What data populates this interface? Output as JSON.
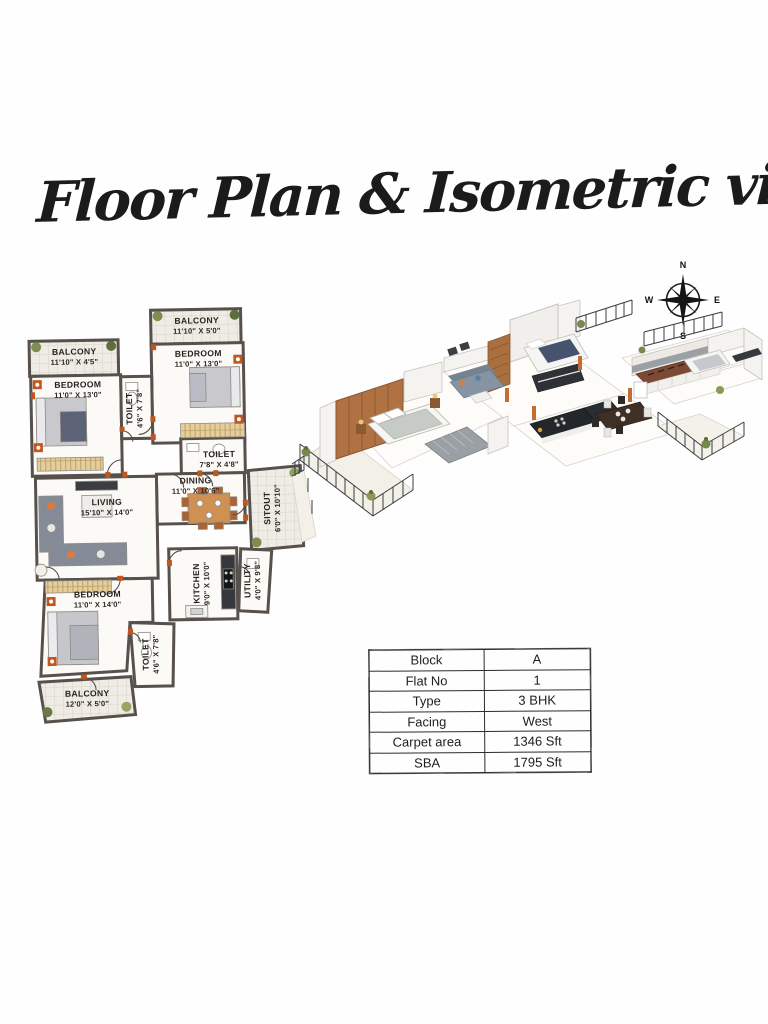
{
  "page": {
    "title": "Floor Plan & Isometric view"
  },
  "compass": {
    "north": "N",
    "east": "E",
    "south": "S",
    "west": "W"
  },
  "floor_plan": {
    "rooms": [
      {
        "id": "balcony-top",
        "name": "BALCONY",
        "dims": "11'10\" X 5'0\""
      },
      {
        "id": "bedroom-2",
        "name": "BEDROOM",
        "dims": "11'0\" X 13'0\""
      },
      {
        "id": "balcony-left",
        "name": "BALCONY",
        "dims": "11'10\" X 4'5\""
      },
      {
        "id": "bedroom-1",
        "name": "BEDROOM",
        "dims": "11'0\" X 13'0\""
      },
      {
        "id": "toilet-1",
        "name": "TOILET",
        "dims": "4'6\" X 7'8\""
      },
      {
        "id": "toilet-2",
        "name": "TOILET",
        "dims": "7'8\" X 4'8\""
      },
      {
        "id": "dining",
        "name": "DINING",
        "dims": "11'0\" X 10'6\""
      },
      {
        "id": "sitout",
        "name": "SITOUT",
        "dims": "6'0\" X 10'10\""
      },
      {
        "id": "living",
        "name": "LIVING",
        "dims": "15'10\" X 14'0\""
      },
      {
        "id": "kitchen",
        "name": "KITCHEN",
        "dims": "9'0\" X 10'0\""
      },
      {
        "id": "utility",
        "name": "UTILITY",
        "dims": "4'0\" X 9'8\""
      },
      {
        "id": "bedroom-3",
        "name": "BEDROOM",
        "dims": "11'0\" X 14'0\""
      },
      {
        "id": "toilet-3",
        "name": "TOILET",
        "dims": "4'6\" X 7'8\""
      },
      {
        "id": "balcony-bottom",
        "name": "BALCONY",
        "dims": "12'0\" X 5'0\""
      }
    ],
    "colors": {
      "wall": "#57504b",
      "door_accent": "#c0561f",
      "tile": "#efece5",
      "wardrobe": "#e5cd9c"
    }
  },
  "details_table": {
    "rows": [
      {
        "label": "Block",
        "value": "A"
      },
      {
        "label": "Flat No",
        "value": "1"
      },
      {
        "label": "Type",
        "value": "3 BHK"
      },
      {
        "label": "Facing",
        "value": "West"
      },
      {
        "label": "Carpet area",
        "value": "1346 Sft"
      },
      {
        "label": "SBA",
        "value": "1795 Sft"
      }
    ]
  }
}
